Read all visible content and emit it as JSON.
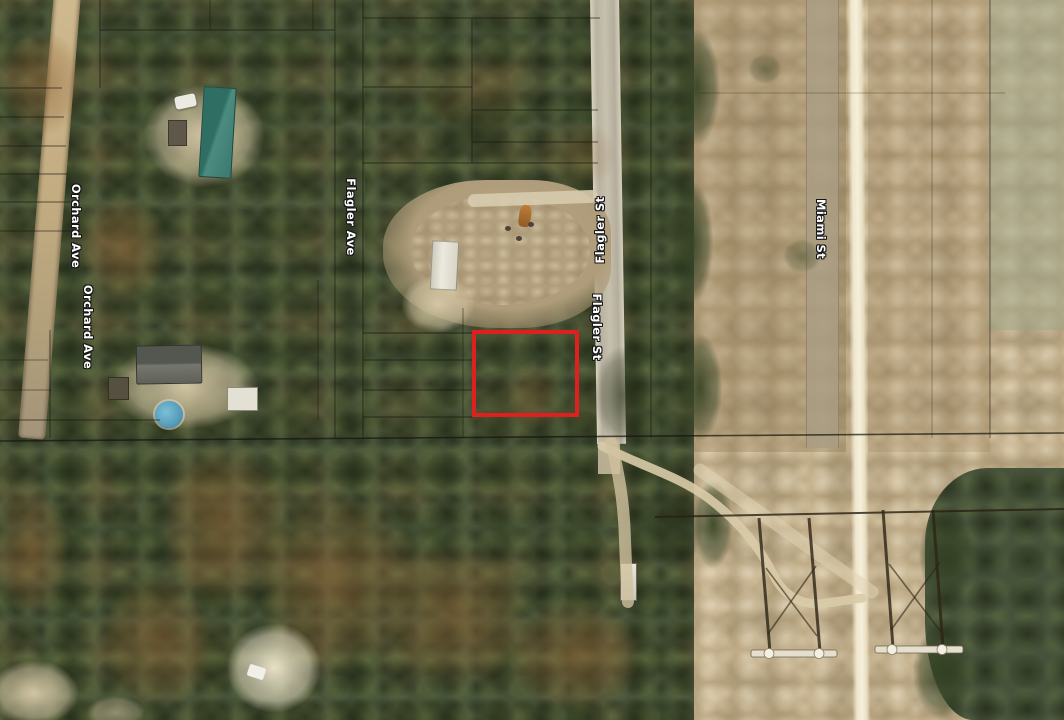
{
  "map": {
    "street_labels": [
      {
        "id": "orchard-ave-upper",
        "text": "Orchard Ave"
      },
      {
        "id": "orchard-ave-lower",
        "text": "Orchard Ave"
      },
      {
        "id": "flagler-ave",
        "text": "Flagler Ave"
      },
      {
        "id": "flagler-st-north",
        "text": "Flagler St"
      },
      {
        "id": "flagler-st-south",
        "text": "Flagler St"
      },
      {
        "id": "miami-st",
        "text": "Miami St"
      }
    ],
    "highlighted_parcel": {
      "border_color": "#e01f1f",
      "border_style": "4px solid #e01f1f"
    }
  }
}
